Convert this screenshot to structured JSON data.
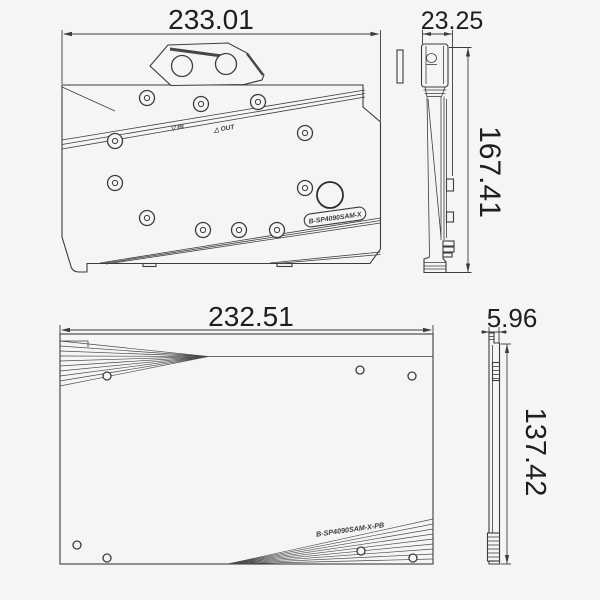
{
  "colors": {
    "background": "#f5f5f5",
    "line": "#3c3c3c",
    "text": "#1e1e1e"
  },
  "front_view": {
    "width_dim": "233.01",
    "port_in_label": "▽ IN",
    "port_out_label": "△ OUT",
    "badge_text": "B-SP4090SAM-X"
  },
  "side_view": {
    "width_dim": "23.25",
    "height_dim": "167.41"
  },
  "backplate_view": {
    "width_dim": "232.51",
    "model_text": "B-SP4090SAM-X-PB"
  },
  "backplate_side_view": {
    "thickness_dim": "5.96",
    "height_dim": "137.42"
  }
}
